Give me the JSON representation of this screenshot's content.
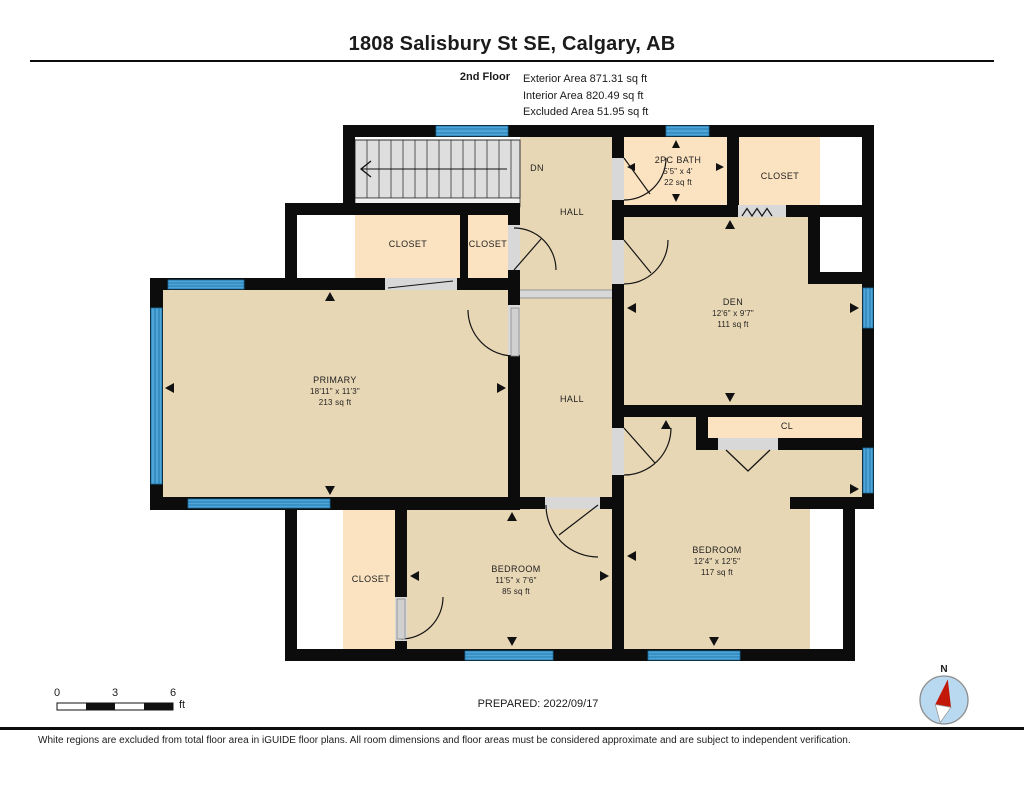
{
  "header": {
    "title": "1808 Salisbury St SE, Calgary, AB",
    "floor_label": "2nd Floor",
    "stats": [
      "Exterior Area 871.31 sq ft",
      "Interior Area 820.49 sq ft",
      "Excluded Area 51.95 sq ft"
    ]
  },
  "rooms": [
    {
      "id": "primary",
      "name": "PRIMARY",
      "dims": "18'11\" x 11'3\"",
      "area": "213 sq ft"
    },
    {
      "id": "hall-upper",
      "name": "HALL"
    },
    {
      "id": "hall-lower",
      "name": "HALL"
    },
    {
      "id": "stairs-direction",
      "name": "DN"
    },
    {
      "id": "bath",
      "name": "2PC BATH",
      "dims": "5'5\" x 4'",
      "area": "22 sq ft"
    },
    {
      "id": "closet-top-right",
      "name": "CLOSET"
    },
    {
      "id": "closet-mid-1",
      "name": "CLOSET"
    },
    {
      "id": "closet-mid-2",
      "name": "CLOSET"
    },
    {
      "id": "den",
      "name": "DEN",
      "dims": "12'6\" x 9'7\"",
      "area": "111 sq ft"
    },
    {
      "id": "cl",
      "name": "CL"
    },
    {
      "id": "bedroom-right",
      "name": "BEDROOM",
      "dims": "12'4\" x 12'5\"",
      "area": "117 sq ft"
    },
    {
      "id": "bedroom-middle",
      "name": "BEDROOM",
      "dims": "11'5\" x 7'6\"",
      "area": "85 sq ft"
    },
    {
      "id": "closet-bottom-left",
      "name": "CLOSET"
    }
  ],
  "footer": {
    "scale": {
      "n0": "0",
      "n3": "3",
      "n6": "6",
      "unit": "ft"
    },
    "prepared": "PREPARED: 2022/09/17",
    "compass_n": "N",
    "disclaimer": "White regions are excluded from total floor area in iGUIDE floor plans. All room dimensions and floor areas must be considered approximate and are subject to independent verification."
  },
  "colors": {
    "room_fill": "#e8d7b5",
    "closet_fill": "#fbe3c1",
    "wall": "#0c0c0c",
    "window_blue": "#4da5d9",
    "stairs_grey": "#dedede",
    "door_opening_grey": "#d8d8d8",
    "compass_circle": "#b9d9f0",
    "compass_needle_red": "#c21807"
  }
}
